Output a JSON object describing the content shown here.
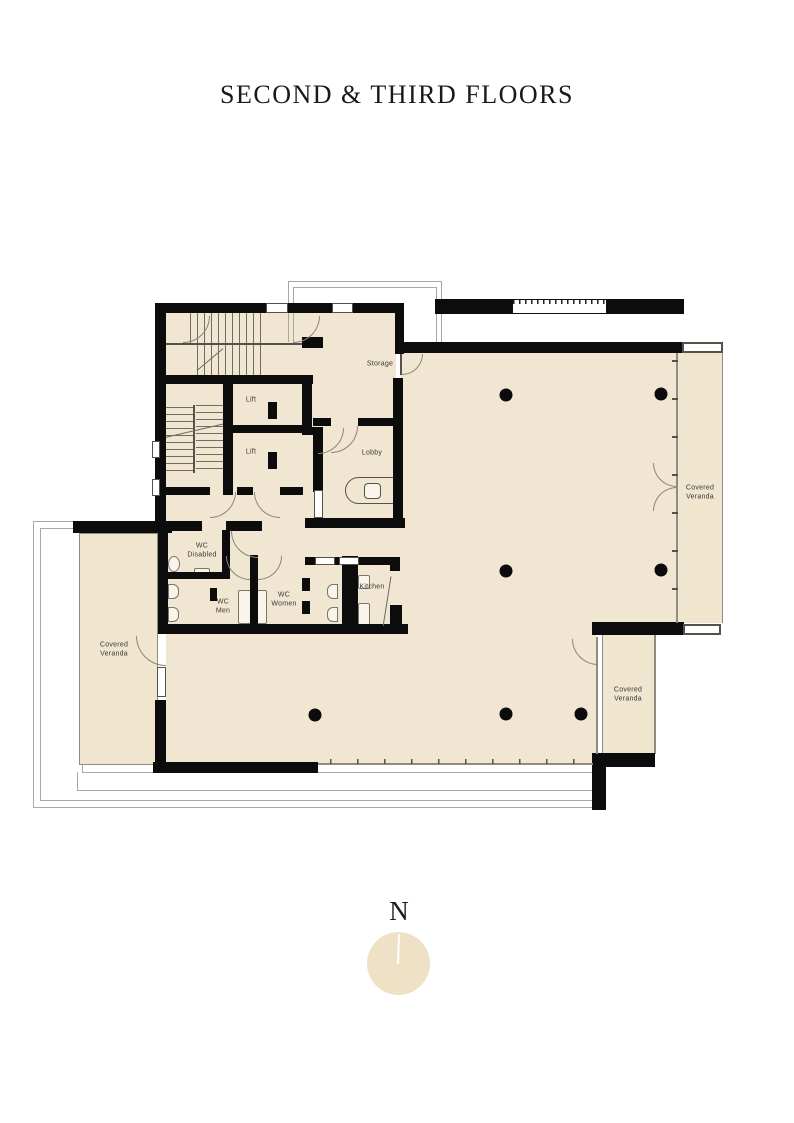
{
  "title": "SECOND & THIRD FLOORS",
  "compass": {
    "label": "N"
  },
  "rooms": {
    "storage": "Storage",
    "lift_upper": "Lift",
    "lift_lower": "Lift",
    "lobby": "Lobby",
    "wc_disabled": "WC Disabled",
    "wc_men": "WC Men",
    "wc_women": "WC Women",
    "kitchen": "Kitchen",
    "veranda_left": "Covered Veranda",
    "veranda_right": "Covered Veranda",
    "veranda_southeast": "Covered Veranda"
  },
  "colors": {
    "floor_fill": "#f1e6d1",
    "wall": "#0c0c0c",
    "thin_line": "#8f8c80",
    "outline": "#aba89f",
    "label_text": "#383838",
    "title_text": "#191919",
    "compass_circle": "#eee1c6"
  }
}
